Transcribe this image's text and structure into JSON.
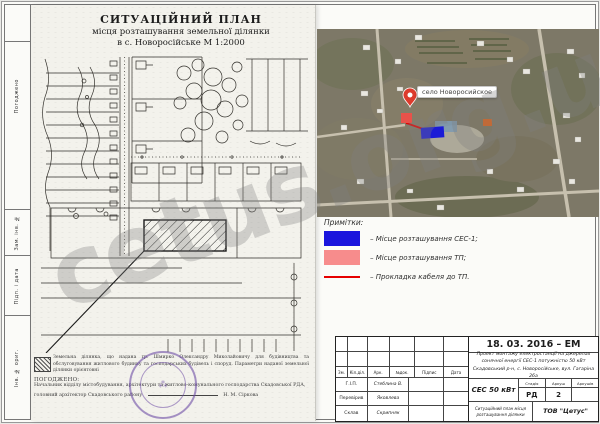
{
  "watermark": {
    "text": "cetus.org.ua"
  },
  "frame": {
    "left_labels": [
      "Погоджено",
      "Зам. інв. №",
      "Підп. і дата",
      "Інв. № ориг."
    ]
  },
  "scan": {
    "title1": "СИТУАЦІЙНИЙ ПЛАН",
    "title2": "місця розташування земельної ділянки",
    "title3": "в с. Новоросійське М 1:2000",
    "note": "Земельна ділянка, що надана гр. Шмирко Олександру Миколайовичу для будівництва та обслуговування житлового будинку та господарських будівель і споруд. Параметри наданої земельної ділянки орієнтовні",
    "agreed_heading": "ПОГОДЖЕНО:",
    "agreed_body": "Начальник відділу містобудування, архітектури та житлово-комунального господарства Скадовської РДА, головний архітектор Скадовського району",
    "agreed_name": "Н. М. Сіркова"
  },
  "satellite": {
    "place_label": "село Новоросийское"
  },
  "legend": {
    "heading": "Примітки:",
    "items": [
      {
        "color": "#1a15dd",
        "label": "– Місце розташування СЕС-1;"
      },
      {
        "color": "#f78c8c",
        "label": "– Місце розташування ТП;"
      },
      {
        "color": "#e60000",
        "label": "– Прокладка кабеля до ТП."
      }
    ]
  },
  "titleblock": {
    "date_code": "18. 03. 2016 – ЕМ",
    "project": "Проект монтажу електростанції на джерелах сонячної енергії СЕС-1 потужністю 50 кВт Скадовський р-н, с. Новоросійське, вул. Гагаріна 26а",
    "object": "СЕС 50 кВт",
    "stage_label": "Стадія",
    "sheet_label": "Аркуш",
    "sheets_label": "Аркушів",
    "stage": "РД",
    "sheet": "2",
    "sheets": "",
    "doc_title": "Ситуаційний план місця розташування ділянки",
    "company": "ТОВ \"Цетус\"",
    "header_cols": [
      "Зм.",
      "Кіл.діл.",
      "Арк.",
      "№док.",
      "Підпис",
      "Дата"
    ],
    "signers": [
      {
        "role": "Г.І.П.",
        "name": "Стеблина В."
      },
      {
        "role": "Перевірив",
        "name": "Яковлева"
      },
      {
        "role": "Склав",
        "name": "Скрипняк"
      }
    ]
  }
}
